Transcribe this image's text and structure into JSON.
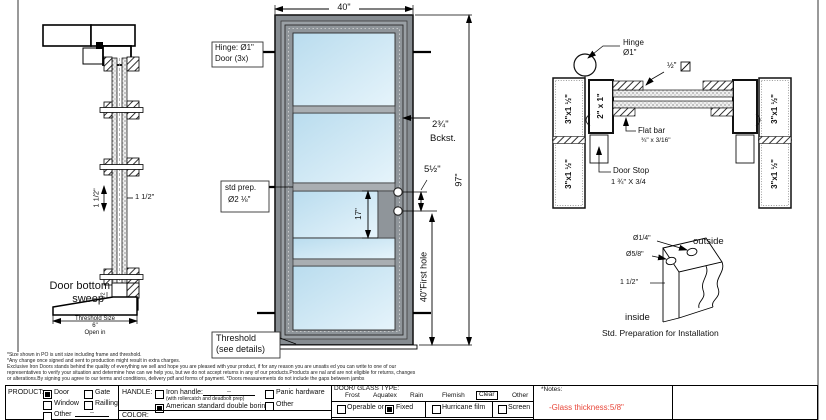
{
  "side_view": {
    "dim_side_rot": "1 1/2\"",
    "dim_side": "1 1/2\"",
    "sweep_label_1": "Door bottom",
    "sweep_label_2": "sweep",
    "sweep_dim": "1/2",
    "threshold_label": "Threshold Size",
    "threshold_value": "6\"",
    "open_in": "Open in"
  },
  "front_view": {
    "width_dim": "40\"",
    "height_dim": "97\"",
    "hinge_note_1": "Hinge: Ø1\"",
    "hinge_note_2": "Door (3x)",
    "backset_value": "2¾\"",
    "backset_label": "Bckst.",
    "lock_spacing": "5½\"",
    "std_prep_1": "std prep.",
    "std_prep_2": "Ø2 ⅛\"",
    "hole_spacing": "17\"",
    "first_hole": "40\"First hole",
    "threshold_note_1": "Threshold",
    "threshold_note_2": "(see details)"
  },
  "section_view": {
    "hinge_label": "Hinge",
    "hinge_dia": "Ø1\"",
    "square_bar": "½\"",
    "stile_size": "2\" x 1\"",
    "frame_size": "3\"x1 ½\"",
    "flat_bar_1": "Flat bar",
    "flat_bar_2": "¾\" x 3/16\"",
    "door_stop_1": "Door Stop",
    "door_stop_2": "1 ¾\" X 3/4"
  },
  "install_detail": {
    "hole_small": "Ø1/4\"",
    "hole_large": "Ø5/8\"",
    "offset": "1 1/2\"",
    "outside": "outside",
    "inside": "inside",
    "caption": "Std. Preparation for Installation"
  },
  "disclaimer": {
    "line1": "*Size shown in PO is unit size including frame and threshold.",
    "line2": "*Any change once signed and sent to production might result in extra charges.",
    "line3": "Exclusive Iron Doors stands behind the quality of everything we sell and hope you are pleased with your product, if for any reason you are unsatis ed you can write to one of our",
    "line4": "representatives to verify your situation and determine how can we help you, but we do not accept returns in any of our products.Products are  nal and are not eligible for returns, changes",
    "line5": "or alterations.By signing you agree to our terms and conditions, delivery pdf and forms of payment. *Doors measurements do not include the gaps between jambs"
  },
  "form": {
    "product": {
      "label": "PRODUCT:",
      "door": "Door",
      "gate": "Gate",
      "window": "Window",
      "railing": "Railling",
      "other": "Other",
      "other_line": "--"
    },
    "handle": {
      "label": "HANDLE:",
      "iron": "Iron handle:",
      "iron_line": "--",
      "iron_sub": "(with rollercatch and deadbolt prep)",
      "american": "American standard double boring",
      "panic": "Panic hardware",
      "other": "Other"
    },
    "color_label": "COLOR:",
    "glass": {
      "label": "DOOR/ GLASS TYPE:",
      "frost": "Frost",
      "aquatex": "Aquatex",
      "rain": "Rain",
      "flemish": "Flemish",
      "clear": "Clear",
      "other": "Other",
      "operable": "Operable or",
      "fixed": "Fixed",
      "hurricane": "Hurricane film",
      "screen": "Screen"
    },
    "notes": {
      "label": "*Notes:",
      "note": "-Glass thickness:5/8\"",
      "note_color": "#e8473a"
    },
    "checked": {
      "product": "Door",
      "handle": "American standard double boring",
      "operable_fixed": "Fixed",
      "glass_type": "Clear"
    }
  },
  "colors": {
    "glass_fill": "#cfe7f5",
    "frame_fill": "#9aa0a5",
    "line": "#1a1a1a",
    "note_red": "#e8473a"
  }
}
